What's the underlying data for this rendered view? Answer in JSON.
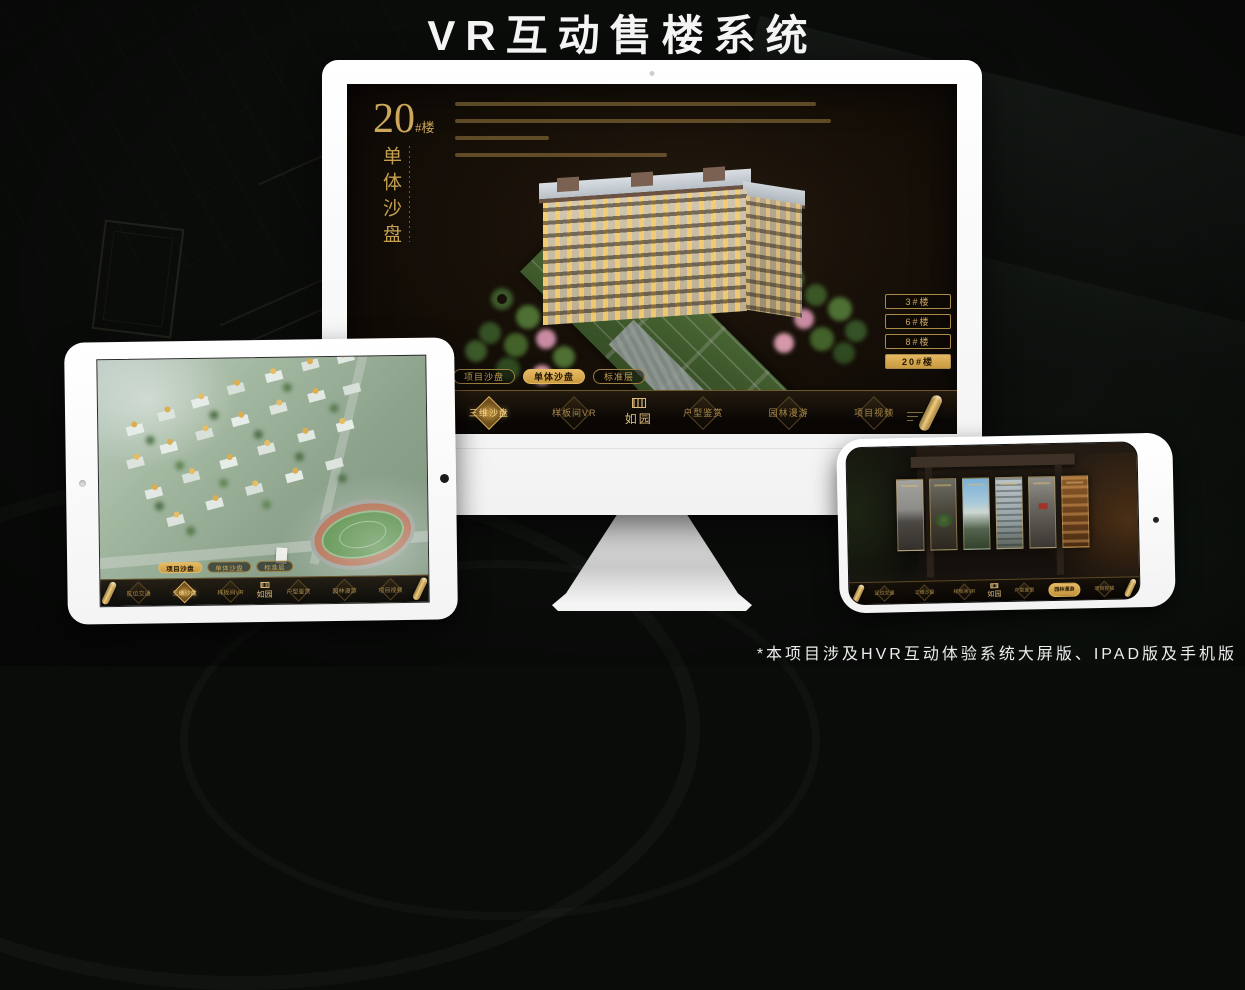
{
  "page": {
    "title": "VR互动售楼系统",
    "footnote": "*本项目涉及HVR互动体验系统大屏版、IPAD版及手机版"
  },
  "brand": {
    "logo": "如园",
    "gold": "#cfa653",
    "gold_active": "#d9a94f"
  },
  "nav": {
    "items": [
      {
        "label": "区位交通"
      },
      {
        "label": "三维沙盘"
      },
      {
        "label": "样板间VR"
      },
      {
        "label": "户型鉴赏"
      },
      {
        "label": "园林漫游"
      },
      {
        "label": "项目视频"
      }
    ]
  },
  "monitor": {
    "headline": {
      "number": "20",
      "suffix": "#楼",
      "vertical": "单体沙盘"
    },
    "floor_buttons": [
      {
        "label": "3#楼"
      },
      {
        "label": "6#楼"
      },
      {
        "label": "8#楼"
      },
      {
        "label": "20#楼"
      }
    ],
    "sub_tabs": [
      {
        "label": "项目沙盘"
      },
      {
        "label": "单体沙盘"
      },
      {
        "label": "标准层"
      }
    ]
  },
  "tablet": {
    "sub_tabs": [
      {
        "label": "项目沙盘"
      },
      {
        "label": "单体沙盘"
      },
      {
        "label": "标准层"
      }
    ]
  }
}
